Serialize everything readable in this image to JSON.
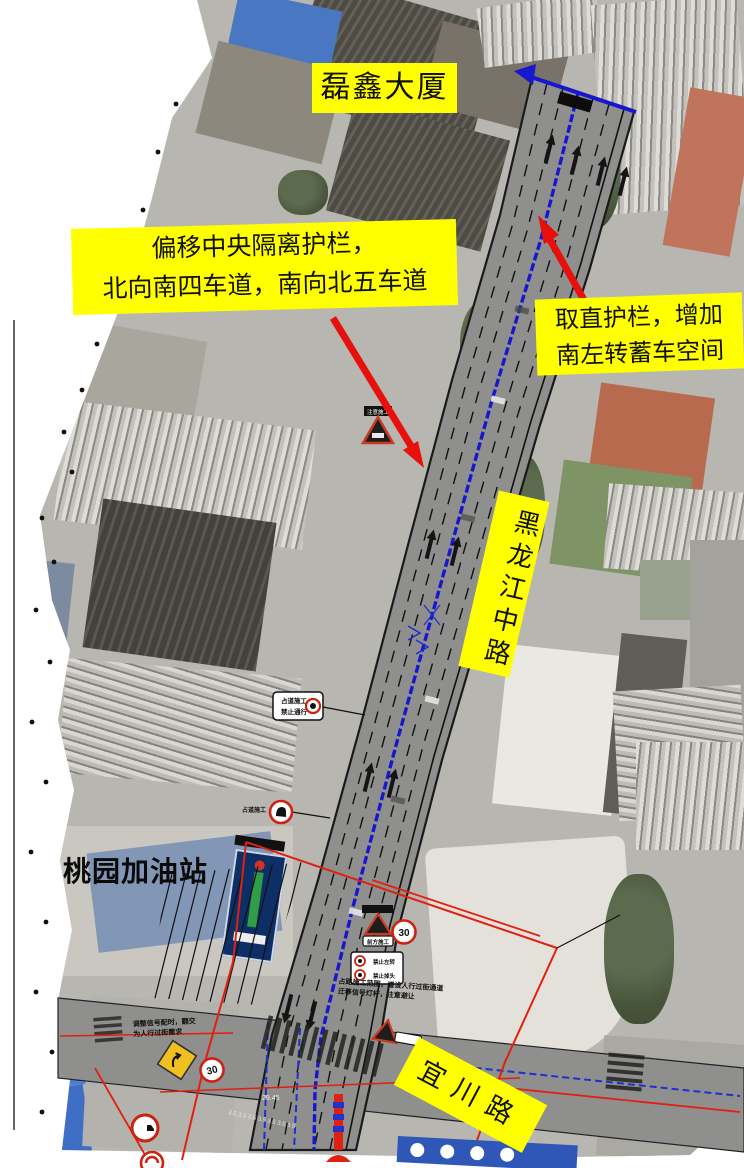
{
  "colors": {
    "label_bg": "#ffff00",
    "arrow_red": "#e8100c",
    "median_line_blue": "#1717cf",
    "work_zone_red": "#e02010"
  },
  "labels": {
    "building_top": "磊鑫大厦",
    "median_note": {
      "line1": "偏移中央隔离护栏，",
      "line2": "北向南四车道，南向北五车道"
    },
    "guardrail_note": {
      "line1": "取直护栏，增加",
      "line2": "南左转蓄车空间"
    },
    "main_road": "黑龙江中路",
    "gas_station": "桃园加油站",
    "cross_road": "宜川路"
  },
  "signs": {
    "construction_plate": "注意施工",
    "warning_plate_bottom": "前方施工",
    "speed_limit": "30",
    "no_stop_sign": {
      "line1": "占道施工",
      "line2": "禁止通行"
    },
    "no_turn_sign": {
      "line1": "禁止左转",
      "line2": "禁止掉头"
    },
    "roadside_note": "占道施工"
  },
  "notes": {
    "small_note_right": {
      "line1": "占路施工范围，增设人行过街通道",
      "line2": "迁移信号灯杆，注意避让"
    },
    "small_note_left": {
      "line1": "调整信号配时，翻交",
      "line2": "为人行过街需求"
    }
  },
  "dimensions": {
    "total_width": "29.45",
    "lane_widths": "3.5 3.5 3.5 3.5 3.5 3.5 3.5"
  }
}
